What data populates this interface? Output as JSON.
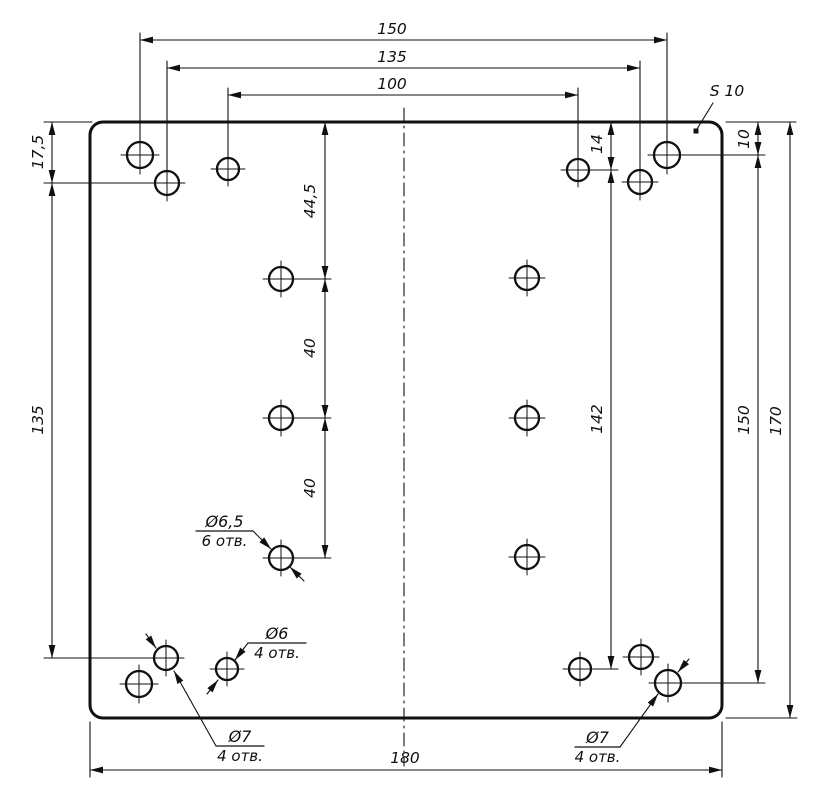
{
  "page": {
    "background": "#ffffff"
  },
  "drawing": {
    "canvas": {
      "width": 833,
      "height": 809,
      "line_color": "#101010",
      "background": "#ffffff"
    },
    "plate": {
      "x": 90,
      "y": 122,
      "width": 632,
      "height": 596,
      "corner_radius": 13,
      "stroke_width": 3
    },
    "centerline": {
      "x": 404,
      "y1": 108,
      "y2": 766,
      "dash": "13 5 2 5"
    },
    "holes": [
      {
        "name": "hole-d7-150-top-left",
        "x": 140,
        "y": 155,
        "r": 13
      },
      {
        "name": "hole-d7-135-top-left",
        "x": 167,
        "y": 183,
        "r": 12
      },
      {
        "name": "hole-d6-top-left",
        "x": 228,
        "y": 169,
        "r": 11
      },
      {
        "name": "hole-d6-top-right",
        "x": 578,
        "y": 170,
        "r": 11
      },
      {
        "name": "hole-d7-135-top-right",
        "x": 640,
        "y": 182,
        "r": 12
      },
      {
        "name": "hole-d7-150-top-right",
        "x": 667,
        "y": 155,
        "r": 13
      },
      {
        "name": "hole-d65-left-1",
        "x": 281,
        "y": 279,
        "r": 12
      },
      {
        "name": "hole-d65-left-2",
        "x": 281,
        "y": 418,
        "r": 12
      },
      {
        "name": "hole-d65-left-3",
        "x": 281,
        "y": 558,
        "r": 12
      },
      {
        "name": "hole-d65-right-1",
        "x": 527,
        "y": 278,
        "r": 12
      },
      {
        "name": "hole-d65-right-2",
        "x": 527,
        "y": 418,
        "r": 12
      },
      {
        "name": "hole-d65-right-3",
        "x": 527,
        "y": 557,
        "r": 12
      },
      {
        "name": "hole-d7-150-bottom-left",
        "x": 139,
        "y": 684,
        "r": 13
      },
      {
        "name": "hole-d7-135-bottom-left",
        "x": 166,
        "y": 658,
        "r": 12
      },
      {
        "name": "hole-d6-bottom-left",
        "x": 227,
        "y": 669,
        "r": 11
      },
      {
        "name": "hole-d6-bottom-right",
        "x": 580,
        "y": 669,
        "r": 11
      },
      {
        "name": "hole-d7-135-bottom-right",
        "x": 641,
        "y": 657,
        "r": 12
      },
      {
        "name": "hole-d7-150-bottom-right",
        "x": 668,
        "y": 683,
        "r": 13
      }
    ],
    "dimensions": [
      {
        "name": "dim-150-top",
        "label": "150",
        "line": [
          140,
          40,
          667,
          40
        ],
        "ext": [
          [
            140,
            33,
            140,
            146
          ],
          [
            667,
            33,
            667,
            146
          ]
        ],
        "label_pos": [
          392,
          34
        ],
        "rot": 0
      },
      {
        "name": "dim-135-top",
        "label": "135",
        "line": [
          167,
          68,
          640,
          68
        ],
        "ext": [
          [
            167,
            61,
            167,
            174
          ],
          [
            640,
            61,
            640,
            173
          ]
        ],
        "label_pos": [
          392,
          62
        ],
        "rot": 0
      },
      {
        "name": "dim-100-top",
        "label": "100",
        "line": [
          228,
          95,
          578,
          95
        ],
        "ext": [
          [
            228,
            88,
            228,
            160
          ],
          [
            578,
            88,
            578,
            161
          ]
        ],
        "label_pos": [
          392,
          89
        ],
        "rot": 0
      },
      {
        "name": "dim-17_5-left",
        "label": "17,5",
        "line": [
          52,
          122,
          52,
          183
        ],
        "ext": [
          [
            44,
            122,
            92,
            122
          ],
          [
            44,
            183,
            152,
            183
          ]
        ],
        "label_pos": [
          43,
          152
        ],
        "rot": -90
      },
      {
        "name": "dim-135-left",
        "label": "135",
        "line": [
          52,
          183,
          52,
          658
        ],
        "ext": [
          [
            44,
            658,
            151,
            658
          ]
        ],
        "label_pos": [
          43,
          420
        ],
        "rot": -90
      },
      {
        "name": "dim-44_5-mid",
        "label": "44,5",
        "line": [
          325,
          122,
          325,
          279
        ],
        "ext": [
          [
            267,
            279,
            331,
            279
          ]
        ],
        "label_pos": [
          315,
          201
        ],
        "rot": -90
      },
      {
        "name": "dim-40-mid-a",
        "label": "40",
        "line": [
          325,
          279,
          325,
          418
        ],
        "ext": [
          [
            267,
            418,
            331,
            418
          ]
        ],
        "label_pos": [
          315,
          348
        ],
        "rot": -90
      },
      {
        "name": "dim-40-mid-b",
        "label": "40",
        "line": [
          325,
          418,
          325,
          558
        ],
        "ext": [
          [
            267,
            558,
            331,
            558
          ]
        ],
        "label_pos": [
          315,
          488
        ],
        "rot": -90
      },
      {
        "name": "dim-14-inner",
        "label": "14",
        "line": [
          611,
          122,
          611,
          170
        ],
        "ext": [
          [
            592,
            170,
            618,
            170
          ]
        ],
        "label_pos": [
          602,
          144
        ],
        "rot": -90
      },
      {
        "name": "dim-142-inner",
        "label": "142",
        "line": [
          611,
          170,
          611,
          669
        ],
        "ext": [
          [
            594,
            669,
            618,
            669
          ]
        ],
        "label_pos": [
          602,
          419
        ],
        "rot": -90
      },
      {
        "name": "dim-10-right",
        "label": "10",
        "line": [
          758,
          122,
          758,
          155
        ],
        "ext": [
          [
            726,
            122,
            796,
            122
          ],
          [
            681,
            155,
            765,
            155
          ]
        ],
        "label_pos": [
          749,
          139
        ],
        "rot": -90
      },
      {
        "name": "dim-150-right",
        "label": "150",
        "line": [
          758,
          155,
          758,
          683
        ],
        "ext": [
          [
            682,
            683,
            765,
            683
          ]
        ],
        "label_pos": [
          749,
          420
        ],
        "rot": -90
      },
      {
        "name": "dim-170-right",
        "label": "170",
        "line": [
          790,
          122,
          790,
          718
        ],
        "ext": [
          [
            726,
            718,
            797,
            718
          ]
        ],
        "label_pos": [
          781,
          421
        ],
        "rot": -90
      },
      {
        "name": "dim-180-bottom",
        "label": "180",
        "line": [
          90,
          770,
          722,
          770
        ],
        "ext": [
          [
            90,
            722,
            90,
            777
          ],
          [
            722,
            722,
            722,
            777
          ]
        ],
        "label_pos": [
          405,
          763
        ],
        "rot": 0
      }
    ],
    "callouts": [
      {
        "name": "callout-d6_5",
        "lines": [
          "Ø6,5",
          "6 отв."
        ],
        "underline": [
          196,
          531,
          253,
          531
        ],
        "leader": [
          [
            253,
            531
          ],
          [
            271,
            549
          ]
        ],
        "extra": [
          [
            304,
            581
          ],
          [
            290,
            567
          ]
        ]
      },
      {
        "name": "callout-d6",
        "lines": [
          "Ø6",
          "4 отв."
        ],
        "underline": [
          248,
          643,
          306,
          643
        ],
        "leader": [
          [
            248,
            643
          ],
          [
            235,
            660
          ]
        ],
        "extra": [
          [
            207,
            694
          ],
          [
            218,
            680
          ]
        ]
      },
      {
        "name": "callout-d7-bottom-left",
        "lines": [
          "Ø7",
          "4 отв."
        ],
        "underline": [
          216,
          746,
          264,
          746
        ],
        "leader": [
          [
            216,
            746
          ],
          [
            174,
            671
          ]
        ],
        "extra": [
          [
            146,
            634
          ],
          [
            156,
            648
          ]
        ]
      },
      {
        "name": "callout-d7-bottom-right",
        "lines": [
          "Ø7",
          "4 отв."
        ],
        "underline": [
          575,
          747,
          620,
          747
        ],
        "leader": [
          [
            620,
            747
          ],
          [
            658,
            694
          ]
        ],
        "extra": [
          [
            689,
            659
          ],
          [
            678,
            672
          ]
        ]
      }
    ],
    "surface_note": {
      "name": "surface-thickness-note",
      "label": "S 10",
      "text_pos": [
        727,
        96
      ],
      "leader": [
        [
          713,
          103
        ],
        [
          697,
          129
        ]
      ],
      "dot": [
        696,
        131
      ]
    }
  }
}
